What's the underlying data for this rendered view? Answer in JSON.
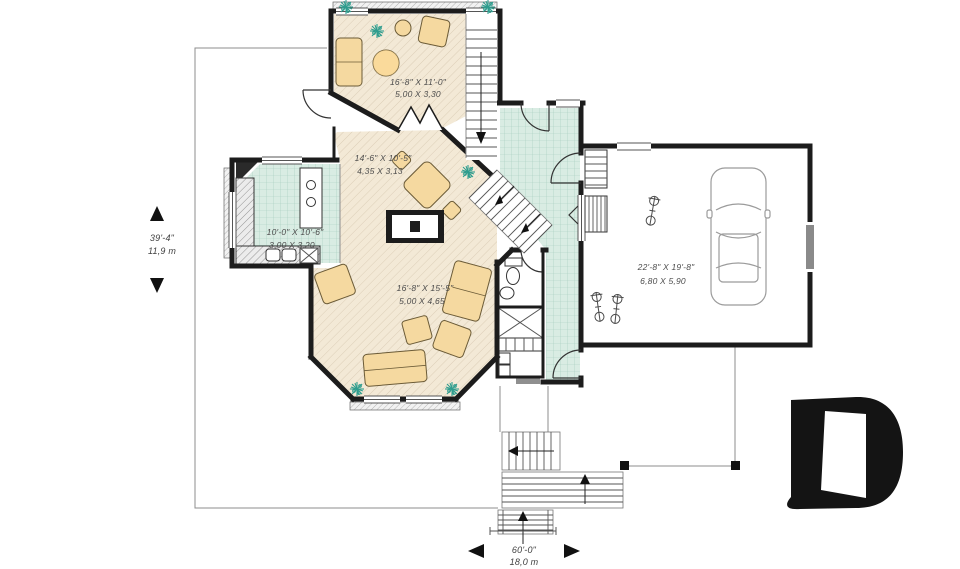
{
  "rooms": {
    "sunroom": {
      "imperial": "16'-8\" X 11'-0\"",
      "metric": "5,00 X 3,30"
    },
    "dining": {
      "imperial": "14'-6\" X 10'-5\"",
      "metric": "4,35 X 3,13"
    },
    "kitchen": {
      "imperial": "10'-0\" X 10'-6\"",
      "metric": "3,00 X 3,20"
    },
    "living": {
      "imperial": "16'-8\" X 15'-5\"",
      "metric": "5,00 X 4,65"
    },
    "garage": {
      "imperial": "22'-8\" X 19'-8\"",
      "metric": "6,80 X 5,90"
    }
  },
  "dimensions": {
    "depth": {
      "imperial": "39'-4\"",
      "metric": "11,9 m"
    },
    "width": {
      "imperial": "60'-0\"",
      "metric": "18,0 m"
    }
  },
  "icons": {
    "logo": "drummond-d-monogram",
    "stair_arrow": "direction-arrow",
    "plant": "plant-symbol",
    "dimension_arrows": "measure-triangles"
  },
  "colors": {
    "wall": "#1c1c1c",
    "floor_wood": "#f3e9d6",
    "floor_tile": "#d9ece3",
    "furniture": "#f5d9a0",
    "plants": "#2f9d8e",
    "outline": "#9a9a9a",
    "label_text": "#4c4c4c",
    "logo": "#141414"
  }
}
